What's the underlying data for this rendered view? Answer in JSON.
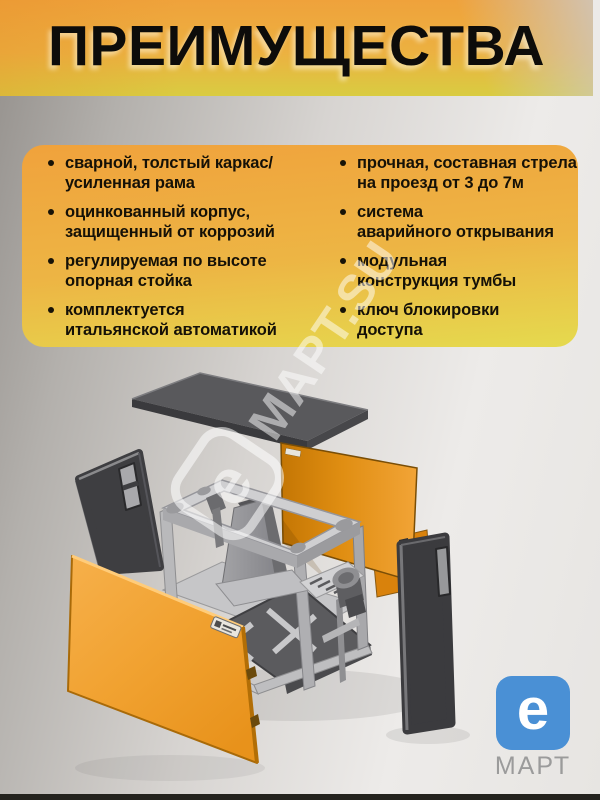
{
  "header": {
    "title": "ПРЕИМУЩЕСТВА"
  },
  "advantages": {
    "left": [
      {
        "line1": "сварной, толстый каркас/",
        "line2": "усиленная рама"
      },
      {
        "line1": "оцинкованный корпус,",
        "line2": "защищенный от коррозий"
      },
      {
        "line1": "регулируемая по высоте",
        "line2": "опорная стойка"
      },
      {
        "line1": "комплектуется",
        "line2": "итальянской автоматикой"
      }
    ],
    "right": [
      {
        "line1": "прочная, составная стрела",
        "line2": "на проезд от 3 до 7м"
      },
      {
        "line1": "система",
        "line2": "аварийного открывания"
      },
      {
        "line1": "модульная",
        "line2": "конструкция тумбы"
      },
      {
        "line1": "ключ блокировки",
        "line2": "доступа"
      }
    ]
  },
  "watermark": {
    "symbol": "e",
    "text": "МАРТ.SU"
  },
  "logo": {
    "symbol": "e",
    "caption": "МАРТ"
  },
  "colors": {
    "header_orange": "#EFA23B",
    "header_yellow": "#D9CC41",
    "card_orange": "#F0A23C",
    "card_yellow": "#E5DA4E",
    "panel_orange": "#F0A232",
    "panel_orange_dark": "#CB7A06",
    "dark_panel": "#3B3B3E",
    "metal_gray": "#CFCFD1",
    "logo_blue": "#4A90D5",
    "text_black": "#151107"
  }
}
